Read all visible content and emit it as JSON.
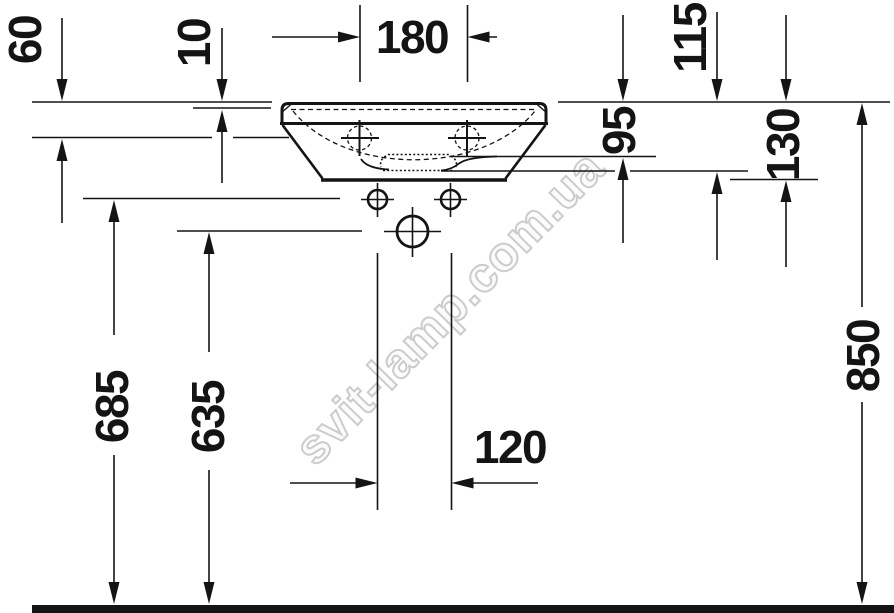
{
  "colors": {
    "ink": "#141414",
    "background": "#ffffff",
    "watermark": "#cccccc"
  },
  "watermark": {
    "text": "svit-lamp.com.ua"
  },
  "dimensions": {
    "d60": "60",
    "d10": "10",
    "d180": "180",
    "d115": "115",
    "d95": "95",
    "d130": "130",
    "d685": "685",
    "d635": "635",
    "d120": "120",
    "d850": "850"
  }
}
